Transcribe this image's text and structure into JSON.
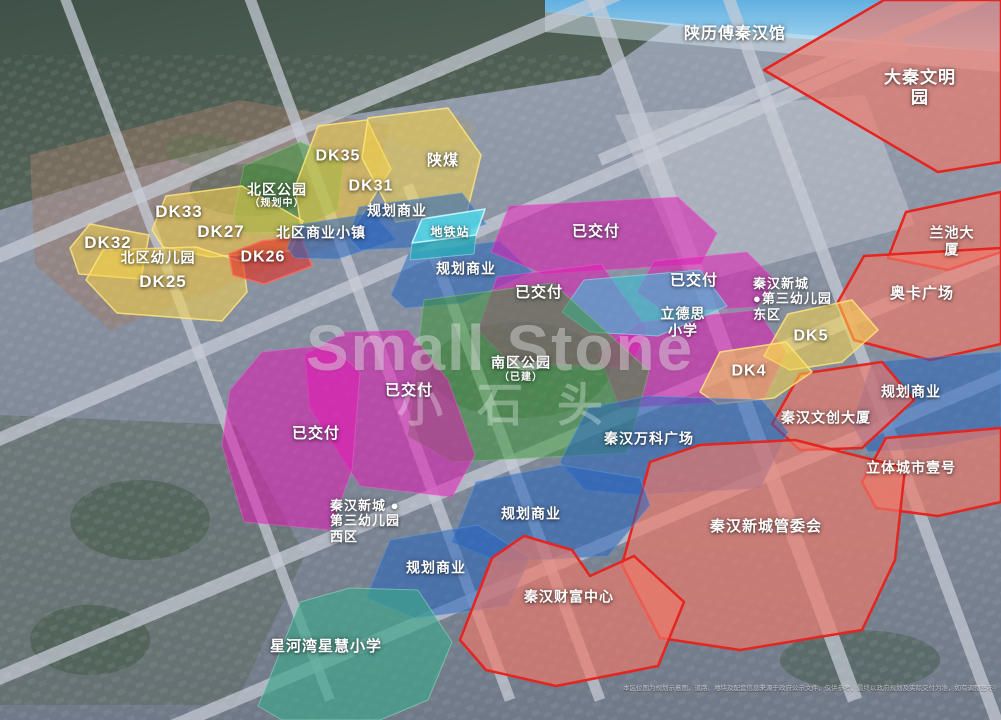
{
  "watermark": {
    "line1": "Small Stone",
    "line2": "小石头"
  },
  "disclaimer": "本区位图为规划示意图，道路、地块及配套信息来源于政府公示文件，仅供参考，最终以政府规划及实际交付为准，如有调整恕不另行通知 2023年8月",
  "colors": {
    "plot_yellow": "#f6d34a",
    "plot_red": "#e43026",
    "park_green": "#3a9634",
    "biz_blue": "#2664be",
    "metro_cyan": "#55dde8",
    "metro_cyan_dark": "#2da8b8",
    "school_cyan": "#3cbed7",
    "delivered_magenta": "#e119b4",
    "gov_red_fill": "#f07869",
    "gov_red_border": "#e42520",
    "school_teal": "#3ea58a"
  },
  "zones": [
    {
      "id": "daqin",
      "type": "red_area"
    },
    {
      "id": "lanchi",
      "type": "red_area"
    },
    {
      "id": "aoka",
      "type": "red_area"
    },
    {
      "id": "ghsy3",
      "type": "biz"
    },
    {
      "id": "wenchuang",
      "type": "red_area"
    },
    {
      "id": "liti",
      "type": "red_area"
    },
    {
      "id": "beiqu_park",
      "type": "park"
    },
    {
      "id": "dk35_31",
      "type": "yellow"
    },
    {
      "id": "shanmei",
      "type": "yellow"
    },
    {
      "id": "dk33_27",
      "type": "yellow"
    },
    {
      "id": "dk32",
      "type": "yellow"
    },
    {
      "id": "dk25",
      "type": "yellow"
    },
    {
      "id": "dk26",
      "type": "red_plot"
    },
    {
      "id": "bizt",
      "type": "biz"
    },
    {
      "id": "ghsy1",
      "type": "biz"
    },
    {
      "id": "ghsy2",
      "type": "biz"
    },
    {
      "id": "metro_front",
      "type": "metro_dark"
    },
    {
      "id": "metro_top",
      "type": "metro"
    },
    {
      "id": "yjf1",
      "type": "delivered"
    },
    {
      "id": "yjf2",
      "type": "delivered"
    },
    {
      "id": "yjf3",
      "type": "delivered"
    },
    {
      "id": "yjf_mid",
      "type": "delivered"
    },
    {
      "id": "lidesi",
      "type": "school_cyan"
    },
    {
      "id": "dk5",
      "type": "yellow"
    },
    {
      "id": "dk4",
      "type": "yellow"
    },
    {
      "id": "nanqu_park",
      "type": "park"
    },
    {
      "id": "yjf4",
      "type": "delivered"
    },
    {
      "id": "yjf5",
      "type": "delivered"
    },
    {
      "id": "wanke",
      "type": "biz"
    },
    {
      "id": "guanweihui",
      "type": "red_area"
    },
    {
      "id": "ghsy4",
      "type": "biz"
    },
    {
      "id": "ghsy5",
      "type": "biz"
    },
    {
      "id": "caifu",
      "type": "red_area"
    },
    {
      "id": "xinghewan",
      "type": "teal"
    }
  ],
  "labels": [
    {
      "id": "l_shaanli",
      "text": "陕历傅秦汉馆"
    },
    {
      "id": "l_daqin",
      "text": "大秦文明园"
    },
    {
      "id": "l_dk35",
      "text": "DK35"
    },
    {
      "id": "l_shanmei",
      "text": "陕煤"
    },
    {
      "id": "l_dk31",
      "text": "DK31"
    },
    {
      "id": "l_beiqu_park",
      "text": "北区公园"
    },
    {
      "id": "l_beiqu_park_sub",
      "text": "（规划中）"
    },
    {
      "id": "l_dk33",
      "text": "DK33"
    },
    {
      "id": "l_dk27",
      "text": "DK27"
    },
    {
      "id": "l_dk32",
      "text": "DK32"
    },
    {
      "id": "l_ghsy1",
      "text": "规划商业"
    },
    {
      "id": "l_metro",
      "text": "地铁站"
    },
    {
      "id": "l_bizt",
      "text": "北区商业小镇"
    },
    {
      "id": "l_beiqu_kg",
      "text": "北区幼儿园"
    },
    {
      "id": "l_dk26",
      "text": "DK26"
    },
    {
      "id": "l_dk25",
      "text": "DK25"
    },
    {
      "id": "l_ghsy2",
      "text": "规划商业"
    },
    {
      "id": "l_yjf1",
      "text": "已交付"
    },
    {
      "id": "l_yjf2",
      "text": "已交付"
    },
    {
      "id": "l_yjf3",
      "text": "已交付"
    },
    {
      "id": "l_kg_east",
      "text": "秦汉新城\n●第三幼儿园\n东区"
    },
    {
      "id": "l_lidesi",
      "text": "立德思\n小学"
    },
    {
      "id": "l_dk5",
      "text": "DK5"
    },
    {
      "id": "l_dk4",
      "text": "DK4"
    },
    {
      "id": "l_lanchi",
      "text": "兰池大厦"
    },
    {
      "id": "l_aoka",
      "text": "奥卡广场"
    },
    {
      "id": "l_ghsy3",
      "text": "规划商业"
    },
    {
      "id": "l_wenchuang",
      "text": "秦汉文创大厦"
    },
    {
      "id": "l_liti",
      "text": "立体城市壹号"
    },
    {
      "id": "l_nanqu_park",
      "text": "南区公园"
    },
    {
      "id": "l_nanqu_park_sub",
      "text": "（已建）"
    },
    {
      "id": "l_yjf4",
      "text": "已交付"
    },
    {
      "id": "l_yjf5",
      "text": "已交付"
    },
    {
      "id": "l_wanke",
      "text": "秦汉万科广场"
    },
    {
      "id": "l_gwh",
      "text": "秦汉新城管委会"
    },
    {
      "id": "l_kg_west",
      "text": "秦汉新城 ●\n第三幼儿园\n西区"
    },
    {
      "id": "l_ghsy4",
      "text": "规划商业"
    },
    {
      "id": "l_ghsy5",
      "text": "规划商业"
    },
    {
      "id": "l_caifu",
      "text": "秦汉财富中心"
    },
    {
      "id": "l_xinghewan",
      "text": "星河湾星慧小学"
    }
  ]
}
